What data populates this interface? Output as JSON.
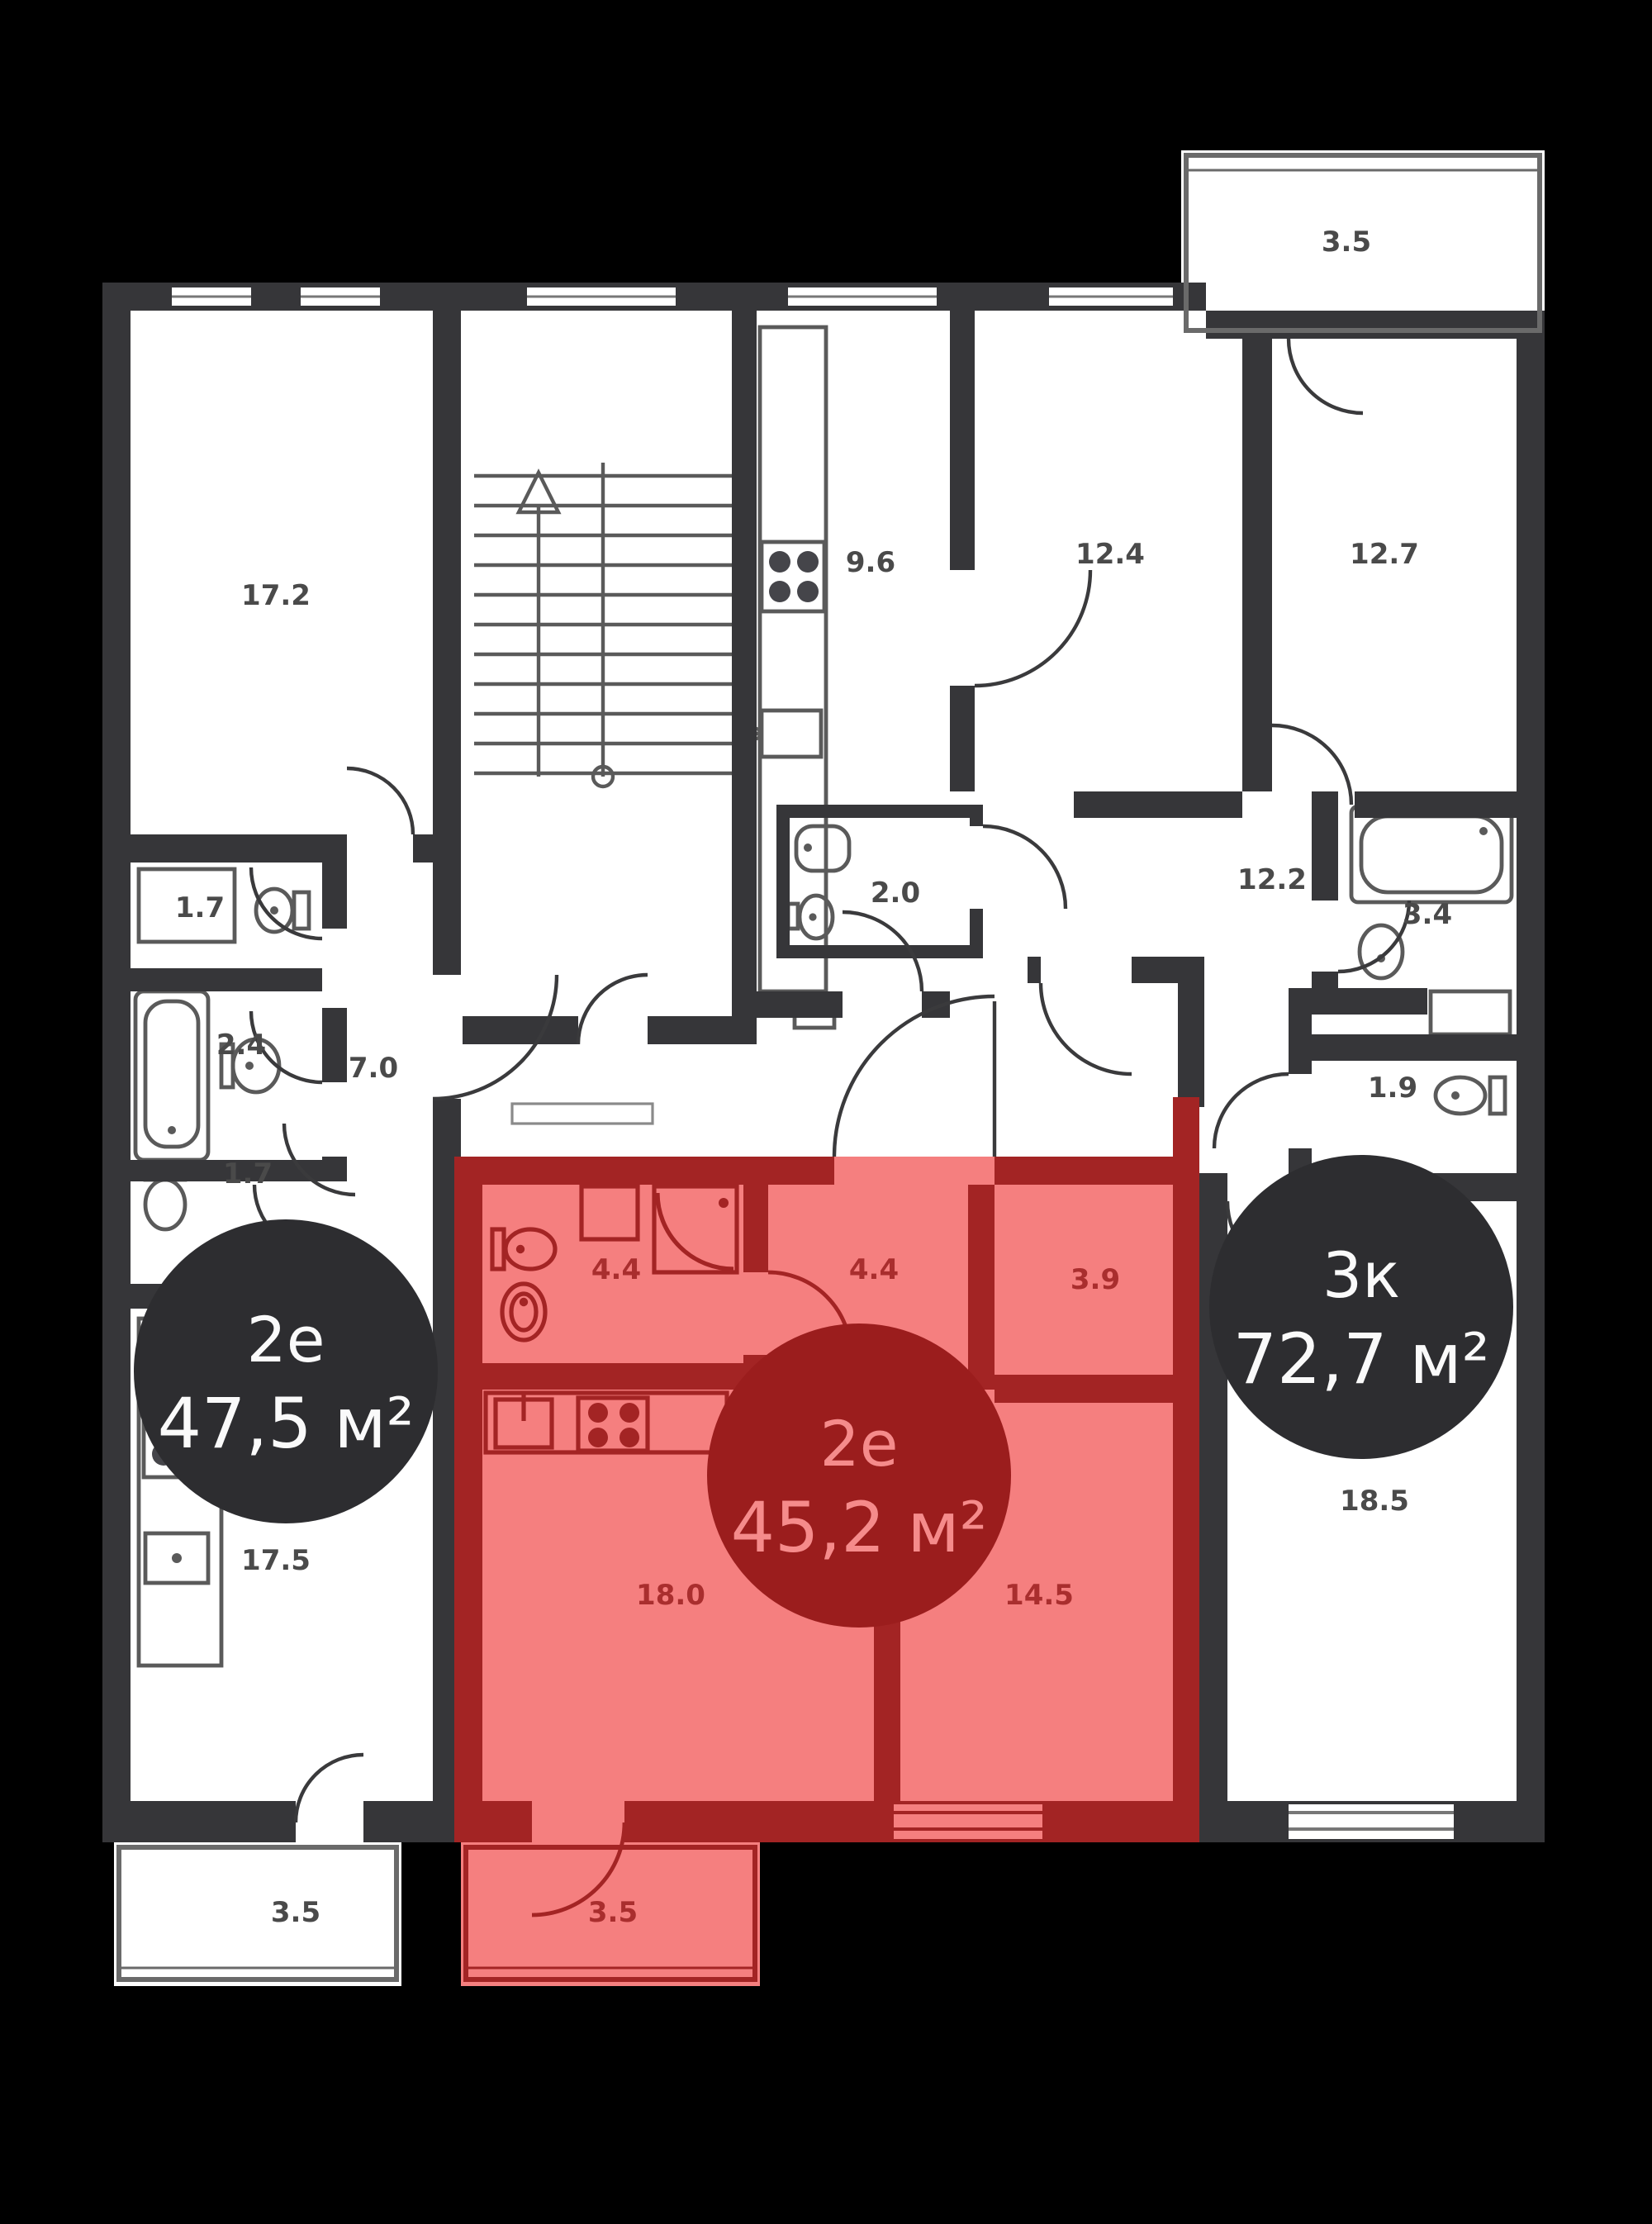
{
  "plan_title": "floor-plan",
  "colors": {
    "background": "#000000",
    "wall": "#363639",
    "room_fill": "#ffffff",
    "highlight_fill": "#f57f7f",
    "highlight_wall": "#a32424",
    "highlight_badge": "#9b1d1d",
    "highlight_badge_text": "#f58b8b",
    "badge": "#2d2d30",
    "badge_text": "#fafafa",
    "area_label": "#4a4a4a",
    "highlight_area_label": "#a92e2e"
  },
  "icons": {
    "stairs": "stairs-icon",
    "stove": "stove-icon",
    "sink": "sink-icon",
    "toilet": "toilet-icon",
    "bathtub": "bathtub-icon",
    "shower": "shower-icon",
    "washer": "washer-icon"
  },
  "apartments": [
    {
      "id": "apt-2e-475",
      "type": "2е",
      "area": "47,5 м²",
      "highlighted": false,
      "rooms": [
        {
          "label": "17.2"
        },
        {
          "label": "1.7"
        },
        {
          "label": "2.4"
        },
        {
          "label": "7.0"
        },
        {
          "label": "1.7"
        },
        {
          "label": "17.5"
        },
        {
          "label": "3.5"
        }
      ]
    },
    {
      "id": "apt-2e-452",
      "type": "2е",
      "area": "45,2 м²",
      "highlighted": true,
      "rooms": [
        {
          "label": "4.4"
        },
        {
          "label": "4.4"
        },
        {
          "label": "3.9"
        },
        {
          "label": "18.0"
        },
        {
          "label": "14.5"
        },
        {
          "label": "3.5"
        }
      ]
    },
    {
      "id": "apt-3k-727",
      "type": "3к",
      "area": "72,7 м²",
      "highlighted": false,
      "rooms": [
        {
          "label": "9.6"
        },
        {
          "label": "12.4"
        },
        {
          "label": "12.7"
        },
        {
          "label": "3.5"
        },
        {
          "label": "2.0"
        },
        {
          "label": "12.2"
        },
        {
          "label": "3.4"
        },
        {
          "label": "1.9"
        },
        {
          "label": "18.5"
        }
      ]
    }
  ]
}
